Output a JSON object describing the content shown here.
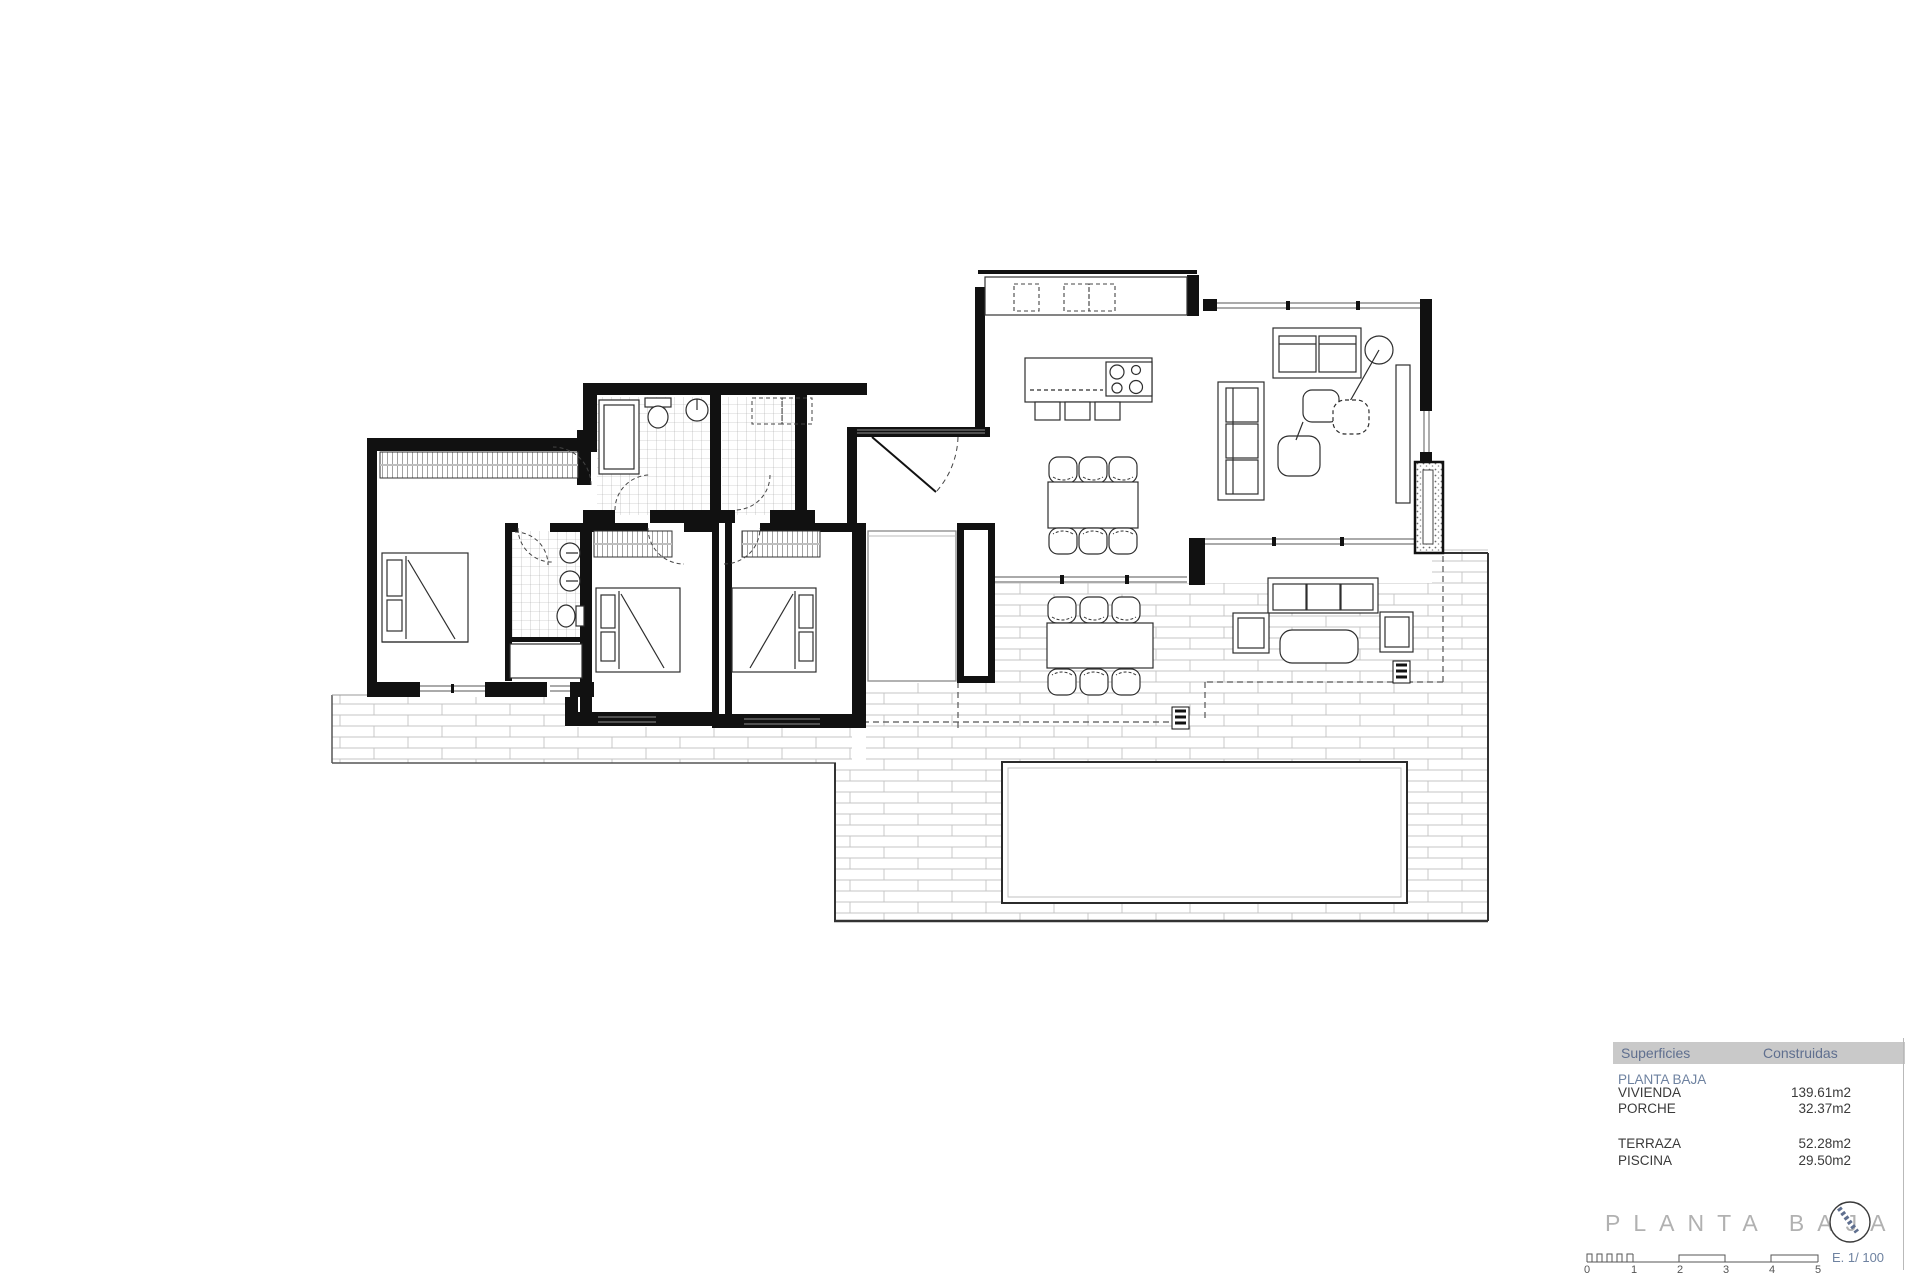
{
  "legend": {
    "header": {
      "col1": "Superficies",
      "col2": "Construidas"
    },
    "section": "PLANTA BAJA",
    "rows": [
      {
        "label": "VIVIENDA",
        "value": "139.61m2"
      },
      {
        "label": "PORCHE",
        "value": "32.37m2"
      },
      {
        "label": "TERRAZA",
        "value": "52.28m2"
      },
      {
        "label": "PISCINA",
        "value": "29.50m2"
      }
    ]
  },
  "title_block": {
    "title": "PLANTA BAJA",
    "scale_label": "E. 1/ 100",
    "scale_ticks": [
      "0",
      "1",
      "2",
      "3",
      "4",
      "5"
    ],
    "north_icon": "north-indicator"
  },
  "colors": {
    "header_bg": "#c9c9c9",
    "header_text": "#5f6f8f",
    "section_text": "#6e82a0",
    "title_text": "#b1b1b1",
    "wall": "#111111",
    "tile_line": "#c4c4c4",
    "fixture_line": "#2e2e2e"
  }
}
